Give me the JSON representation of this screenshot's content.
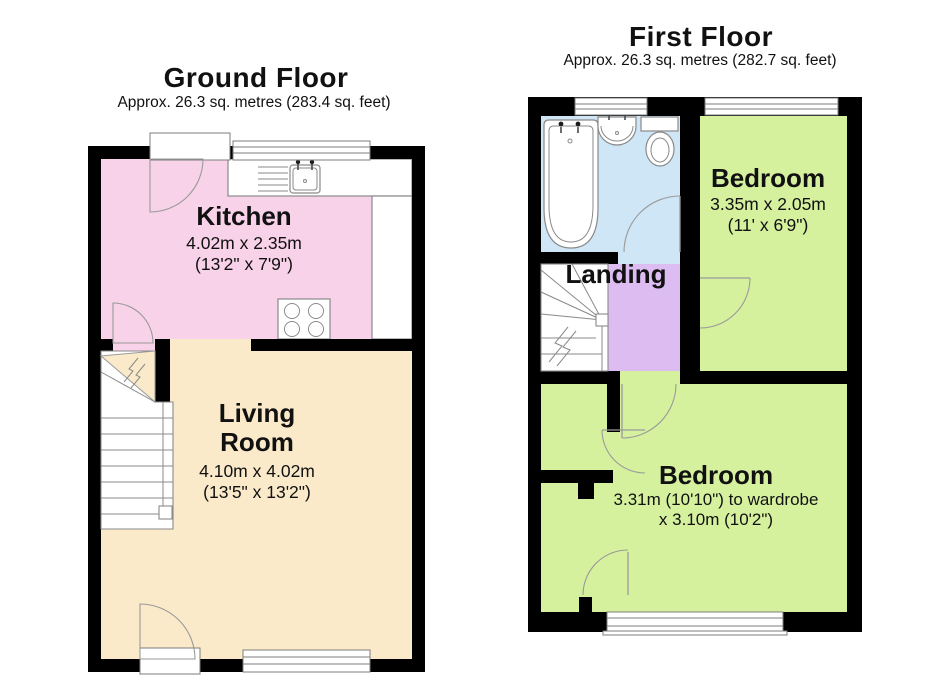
{
  "colors": {
    "kitchen": "#f8d2e8",
    "living_room": "#faeac9",
    "bedroom": "#d6f19e",
    "bathroom": "#cfe6f6",
    "landing": "#dcbcf1",
    "wall": "#000000"
  },
  "ground_floor": {
    "title": "Ground Floor",
    "subtitle": "Approx. 26.3 sq. metres (283.4 sq. feet)",
    "rooms": {
      "kitchen": {
        "name": "Kitchen",
        "size_line1": "4.02m x 2.35m",
        "size_line2": "(13'2\" x 7'9\")"
      },
      "living_room": {
        "name": "Living Room",
        "size_line1": "4.10m x 4.02m",
        "size_line2": "(13'5\" x 13'2\")"
      }
    }
  },
  "first_floor": {
    "title": "First Floor",
    "subtitle": "Approx. 26.3 sq. metres (282.7 sq. feet)",
    "rooms": {
      "bedroom_top": {
        "name": "Bedroom",
        "size_line1": "3.35m x 2.05m",
        "size_line2": "(11' x 6'9\")"
      },
      "landing": {
        "name": "Landing"
      },
      "bedroom_bottom": {
        "name": "Bedroom",
        "size_line1": "3.31m (10'10\") to wardrobe",
        "size_line2": "x 3.10m (10'2\")"
      }
    }
  }
}
